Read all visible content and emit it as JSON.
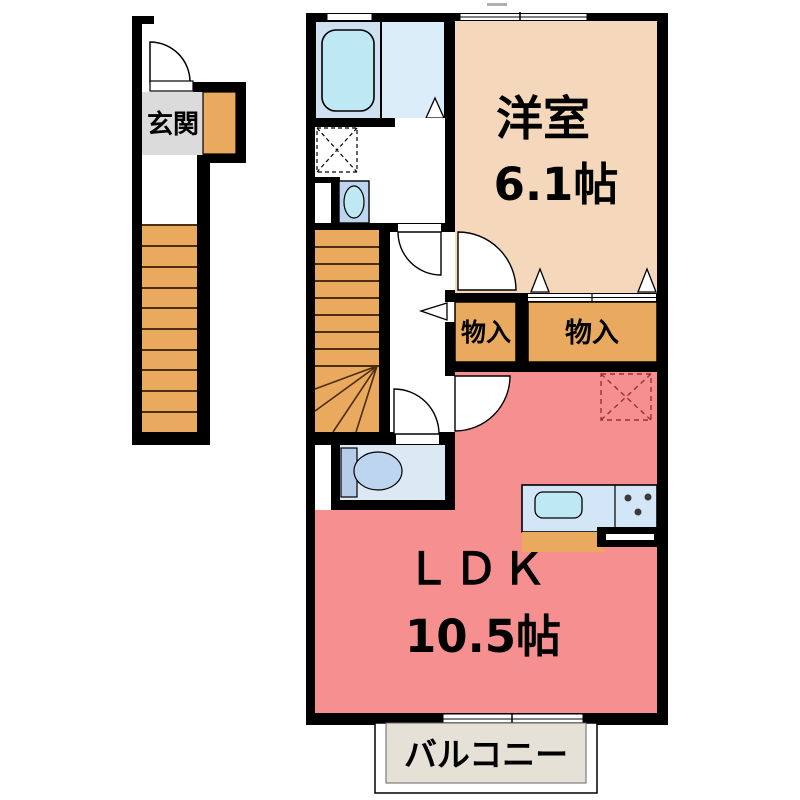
{
  "plan_title": "2F floor plan",
  "colors": {
    "wall": "#000000",
    "stairs_orange": "#E9A95F",
    "genkan_gray": "#DBDBDB",
    "western_beige": "#F5D8BB",
    "ldk_pink": "#F68F8F",
    "bath_blue": "#CFE0F0",
    "tub_cyan": "#BEE8F4",
    "shower_blue": "#DCEDFA",
    "toilet_room_blue": "#DDE8F5",
    "fixture_blue": "#B6CCE9",
    "bowl_blue": "#BDD5EE",
    "counter_blue": "#D3E6F8",
    "balcony_gray": "#E6E1D7",
    "dashed_red": "#993333",
    "tread_brown": "#4D2E0E"
  },
  "rooms": {
    "genkan": {
      "label": "玄関"
    },
    "western": {
      "label": "洋室",
      "size": "6.1帖"
    },
    "closet_left": {
      "label": "物入"
    },
    "closet_right": {
      "label": "物入"
    },
    "ldk": {
      "label": "ＬＤＫ",
      "size": "10.5帖"
    },
    "balcony": {
      "label": "バルコニー"
    }
  }
}
